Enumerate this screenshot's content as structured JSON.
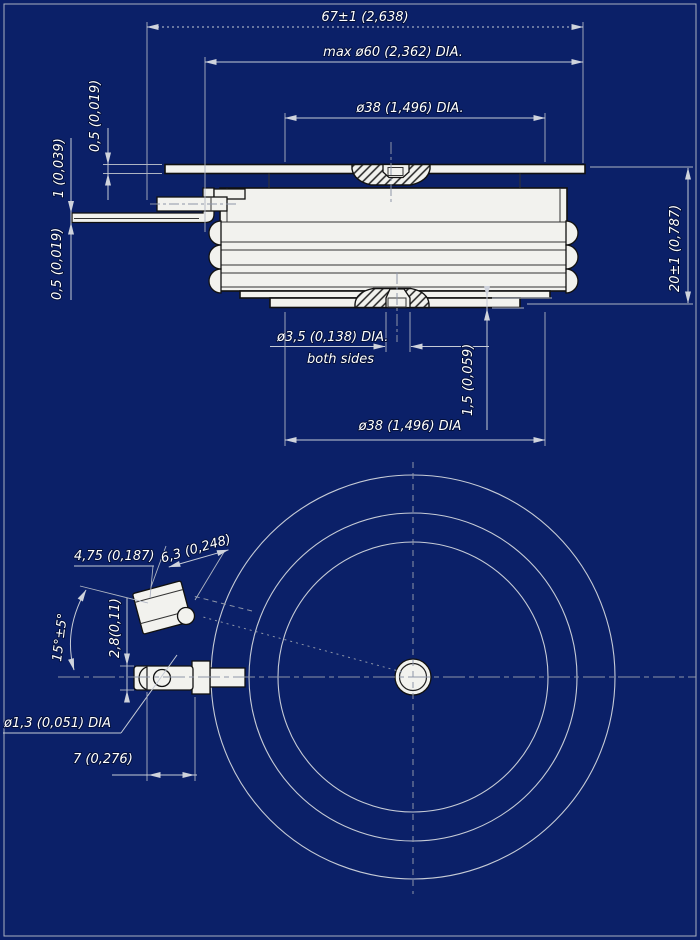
{
  "drawing": {
    "type": "technical-drawing",
    "colors": {
      "background": "#0b2068",
      "part_fill": "#f2f2ee",
      "outline": "#111111",
      "dimension_lines": "#c6cbd6",
      "text": "#ffffff"
    },
    "labels": {
      "dim_overall_width": "67±1 (2,638)",
      "dim_max_dia": "max ø60 (2,362) DIA.",
      "dim_top_contact": "ø38 (1,496) DIA.",
      "dim_plate_thk": "0,5 (0,019)",
      "dim_lead_thk": "1 (0,039)",
      "dim_lead2_thk": "0,5 (0,019)",
      "dim_height": "20±1 (0,787)",
      "dim_gate_hole": "ø3,5 (0,138) DIA.",
      "dim_gate_hole_note": "both sides",
      "dim_pole_offset": "1,5 (0,059)",
      "dim_bottom_contact": "ø38 (1,496) DIA",
      "dim_tab_width": "6,3 (0,248)",
      "dim_tab_setback": "4,75 (0,187)",
      "dim_angle": "15°±5°",
      "dim_tab_dia": "2,8(0,11)",
      "dim_hole_dia": "ø1,3 (0,051) DIA",
      "dim_tab_length": "7 (0,276)"
    }
  }
}
